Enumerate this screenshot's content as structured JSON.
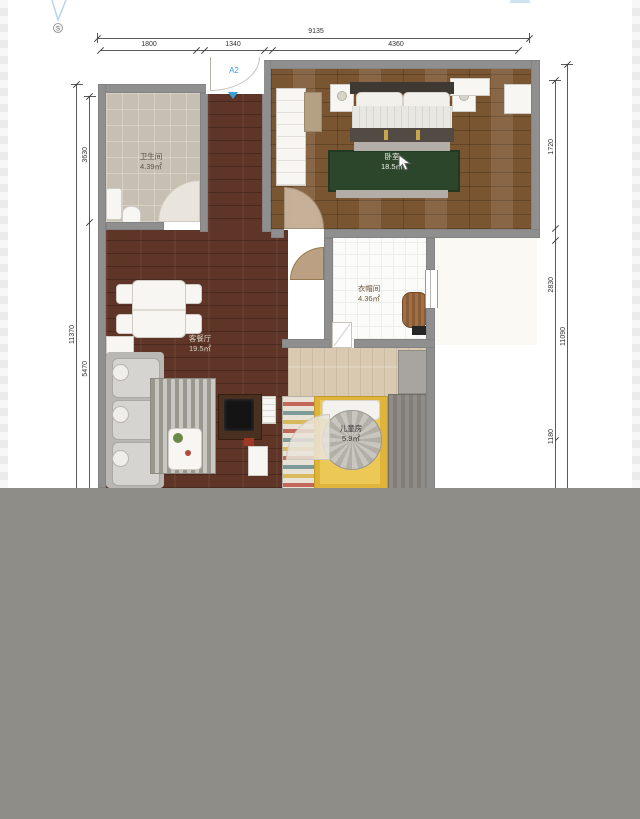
{
  "plan": {
    "compass": {
      "label": "S"
    },
    "entry_door": {
      "label": "A2"
    },
    "rooms": [
      {
        "name": "卫生间",
        "area": "4.39㎡"
      },
      {
        "name": "卧室",
        "area": "18.5㎡"
      },
      {
        "name": "衣帽间",
        "area": "4.36㎡"
      },
      {
        "name": "客餐厅",
        "area": "19.5㎡"
      },
      {
        "name": "儿童房",
        "area": "5.9㎡"
      }
    ],
    "dimensions": {
      "top_total": "9135",
      "top_segments": [
        "1800",
        "1340",
        "4360"
      ],
      "left_outer_total": "11370",
      "left_inner_segments": [
        "3630",
        "5470"
      ],
      "right_outer_total": "11090",
      "right_inner_segments": [
        "1720",
        "2830",
        "1180"
      ]
    },
    "colors": {
      "door_label_blue": "#3aa0d8",
      "wall_gray": "#8f8f8f",
      "overlay_gray": "#8f8d87"
    }
  }
}
